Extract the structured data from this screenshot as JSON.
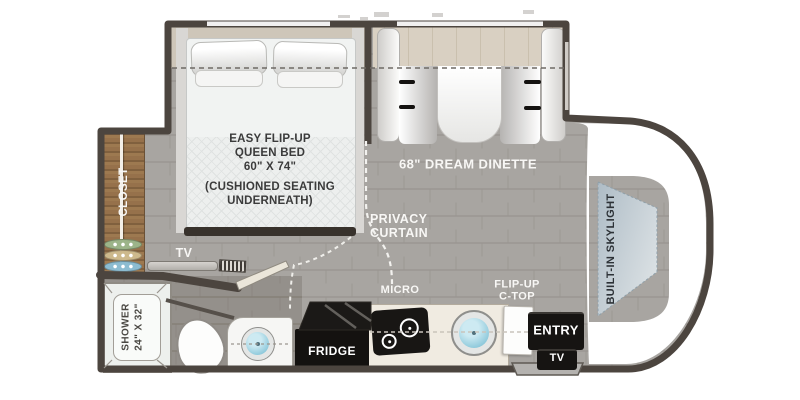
{
  "labels": {
    "bed": {
      "l1": "EASY FLIP-UP",
      "l2": "QUEEN BED",
      "l3": "60\" X 74\"",
      "l4": "(CUSHIONED SEATING",
      "l5": "UNDERNEATH)"
    },
    "dinette": "68\" DREAM DINETTE",
    "privacy": {
      "l1": "PRIVACY",
      "l2": "CURTAIN"
    },
    "closet": "CLOSET",
    "tv_bedroom": "TV",
    "shower": {
      "l1": "SHOWER",
      "l2": "24\" X 32\""
    },
    "micro": "MICRO",
    "fridge": "FRIDGE",
    "ctop": {
      "l1": "FLIP-UP",
      "l2": "C-TOP"
    },
    "entry": "ENTRY",
    "tv_entry": "TV",
    "skylight": "BUILT-IN SKYLIGHT"
  },
  "colors": {
    "wall": "#4c453f",
    "floor": "#a8a5a1",
    "closet_wood": "#96714b",
    "dinette_table_wood": "#d9d0c2",
    "appliance_black": "#161412",
    "sink_blue": "#8ec9db",
    "skylight_blue": "#b9c5cd",
    "label_white": "#f8f7f5",
    "label_dark": "#3b3b3b"
  }
}
